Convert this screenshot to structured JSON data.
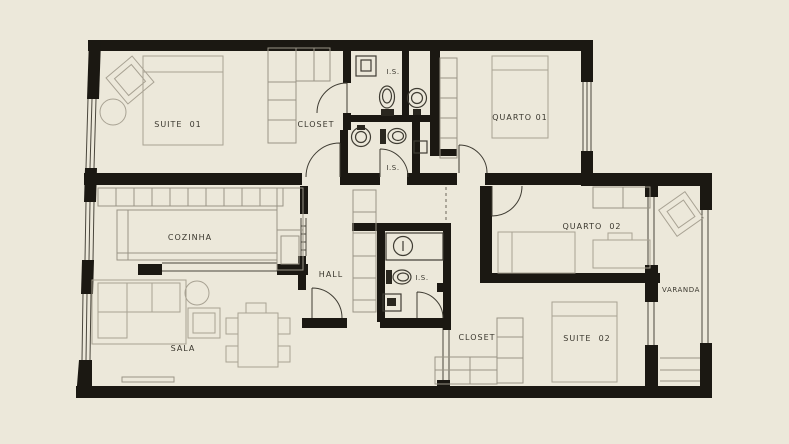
{
  "meta": {
    "title": "Apartment floor plan"
  },
  "colors": {
    "background": "#ece8da",
    "wall": "#1b1812",
    "furniture_line": "#a8a293",
    "fixture_line": "#3f3c33",
    "label_text": "#3a372e"
  },
  "rooms": {
    "suite_01": {
      "label": "SUITE  01"
    },
    "closet_01": {
      "label": "CLOSET"
    },
    "is_top": {
      "label": "I.S."
    },
    "is_mid": {
      "label": "I.S."
    },
    "quarto_01": {
      "label": "QUARTO 01"
    },
    "cozinha": {
      "label": "COZINHA"
    },
    "hall": {
      "label": "HALL"
    },
    "is_hall": {
      "label": "I.S."
    },
    "quarto_02": {
      "label": "QUARTO  02"
    },
    "varanda": {
      "label": "VARANDA"
    },
    "sala": {
      "label": "SALA"
    },
    "closet_02": {
      "label": "CLOSET"
    },
    "suite_02": {
      "label": "SUITE  02"
    }
  }
}
